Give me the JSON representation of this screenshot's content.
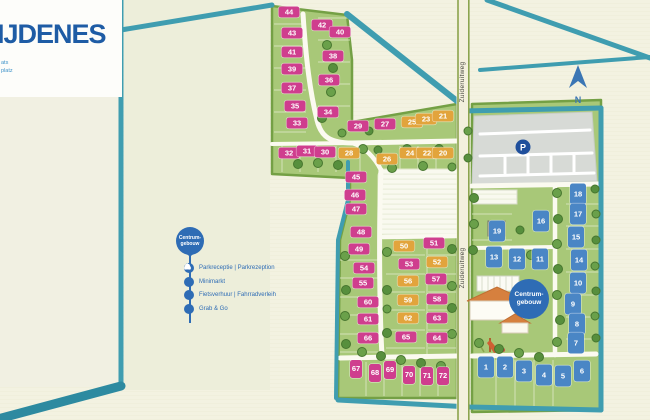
{
  "header": {
    "title": "IJDENES",
    "fragments": [
      "ats",
      "platz"
    ]
  },
  "legend": {
    "pin_line1": "Centrum-",
    "pin_line2": "gebouw",
    "items": [
      {
        "icon": "reception-bell",
        "label": "Parkreceptie | Parkrezeption"
      },
      {
        "icon": "minimarket",
        "label": "Minimarkt"
      },
      {
        "icon": "bicycle",
        "label": "Fietsverhuur | Fahrradverleih"
      },
      {
        "icon": "grab-and-go",
        "label": "Grab & Go"
      }
    ]
  },
  "map": {
    "road_labels": [
      "Zuideruitweg",
      "Zuideruitweg"
    ],
    "parking_label": "P",
    "north_label": "N",
    "centrum_badge": {
      "line1": "Centrum-",
      "line2": "gebouw"
    }
  },
  "colors": {
    "background": "#f3f2e1",
    "park_green": "#a8c878",
    "park_edge": "#74a045",
    "water_teal": "#3f9db0",
    "pink_marker": "#cf3e8e",
    "orange_marker": "#e2a43c",
    "blue_marker": "#4a86c5",
    "legend_blue": "#2e6cb5",
    "title_blue": "#1e5ca5",
    "parking_gray": "#d7dad6"
  },
  "plots": {
    "pink": [
      {
        "n": "44",
        "x": 289,
        "y": 12
      },
      {
        "n": "43",
        "x": 292,
        "y": 33
      },
      {
        "n": "42",
        "x": 322,
        "y": 25
      },
      {
        "n": "41",
        "x": 292,
        "y": 52
      },
      {
        "n": "40",
        "x": 340,
        "y": 32
      },
      {
        "n": "39",
        "x": 292,
        "y": 69
      },
      {
        "n": "38",
        "x": 333,
        "y": 56
      },
      {
        "n": "37",
        "x": 292,
        "y": 88
      },
      {
        "n": "36",
        "x": 329,
        "y": 80
      },
      {
        "n": "35",
        "x": 295,
        "y": 106
      },
      {
        "n": "34",
        "x": 328,
        "y": 112
      },
      {
        "n": "33",
        "x": 297,
        "y": 123
      },
      {
        "n": "32",
        "x": 289,
        "y": 153
      },
      {
        "n": "31",
        "x": 307,
        "y": 151
      },
      {
        "n": "30",
        "x": 325,
        "y": 152
      },
      {
        "n": "29",
        "x": 358,
        "y": 126
      },
      {
        "n": "27",
        "x": 385,
        "y": 124
      },
      {
        "n": "45",
        "x": 356,
        "y": 177
      },
      {
        "n": "46",
        "x": 355,
        "y": 195
      },
      {
        "n": "47",
        "x": 356,
        "y": 209
      },
      {
        "n": "48",
        "x": 361,
        "y": 232
      },
      {
        "n": "49",
        "x": 359,
        "y": 249
      },
      {
        "n": "51",
        "x": 434,
        "y": 243
      },
      {
        "n": "53",
        "x": 409,
        "y": 264
      },
      {
        "n": "54",
        "x": 364,
        "y": 268
      },
      {
        "n": "55",
        "x": 363,
        "y": 283
      },
      {
        "n": "57",
        "x": 436,
        "y": 279
      },
      {
        "n": "58",
        "x": 437,
        "y": 299
      },
      {
        "n": "60",
        "x": 368,
        "y": 302
      },
      {
        "n": "61",
        "x": 368,
        "y": 319
      },
      {
        "n": "63",
        "x": 437,
        "y": 318
      },
      {
        "n": "64",
        "x": 437,
        "y": 338
      },
      {
        "n": "65",
        "x": 406,
        "y": 337
      },
      {
        "n": "66",
        "x": 368,
        "y": 338
      }
    ],
    "pink_vertical": [
      {
        "n": "67",
        "x": 356,
        "y": 369
      },
      {
        "n": "68",
        "x": 375,
        "y": 373
      },
      {
        "n": "69",
        "x": 390,
        "y": 370
      },
      {
        "n": "70",
        "x": 409,
        "y": 375
      },
      {
        "n": "71",
        "x": 427,
        "y": 376
      },
      {
        "n": "72",
        "x": 443,
        "y": 376
      }
    ],
    "orange": [
      {
        "n": "28",
        "x": 349,
        "y": 153
      },
      {
        "n": "26",
        "x": 387,
        "y": 159
      },
      {
        "n": "25",
        "x": 412,
        "y": 122
      },
      {
        "n": "24",
        "x": 410,
        "y": 153
      },
      {
        "n": "23",
        "x": 426,
        "y": 119
      },
      {
        "n": "22",
        "x": 427,
        "y": 153
      },
      {
        "n": "21",
        "x": 443,
        "y": 116
      },
      {
        "n": "20",
        "x": 443,
        "y": 153
      },
      {
        "n": "50",
        "x": 404,
        "y": 246
      },
      {
        "n": "52",
        "x": 437,
        "y": 262
      },
      {
        "n": "56",
        "x": 408,
        "y": 281
      },
      {
        "n": "59",
        "x": 408,
        "y": 300
      },
      {
        "n": "62",
        "x": 408,
        "y": 318
      }
    ],
    "blue": [
      {
        "n": "19",
        "x": 497,
        "y": 231
      },
      {
        "n": "18",
        "x": 578,
        "y": 194
      },
      {
        "n": "17",
        "x": 578,
        "y": 214
      },
      {
        "n": "16",
        "x": 541,
        "y": 221
      },
      {
        "n": "15",
        "x": 576,
        "y": 237
      },
      {
        "n": "14",
        "x": 579,
        "y": 260
      },
      {
        "n": "13",
        "x": 494,
        "y": 257
      },
      {
        "n": "12",
        "x": 517,
        "y": 259
      },
      {
        "n": "11",
        "x": 540,
        "y": 259
      },
      {
        "n": "10",
        "x": 578,
        "y": 283
      },
      {
        "n": "9",
        "x": 573,
        "y": 304
      },
      {
        "n": "8",
        "x": 577,
        "y": 324
      },
      {
        "n": "7",
        "x": 576,
        "y": 343
      },
      {
        "n": "6",
        "x": 582,
        "y": 371
      },
      {
        "n": "5",
        "x": 563,
        "y": 376
      },
      {
        "n": "4",
        "x": 544,
        "y": 375
      },
      {
        "n": "3",
        "x": 524,
        "y": 371
      },
      {
        "n": "2",
        "x": 505,
        "y": 367
      },
      {
        "n": "1",
        "x": 486,
        "y": 367
      }
    ]
  }
}
